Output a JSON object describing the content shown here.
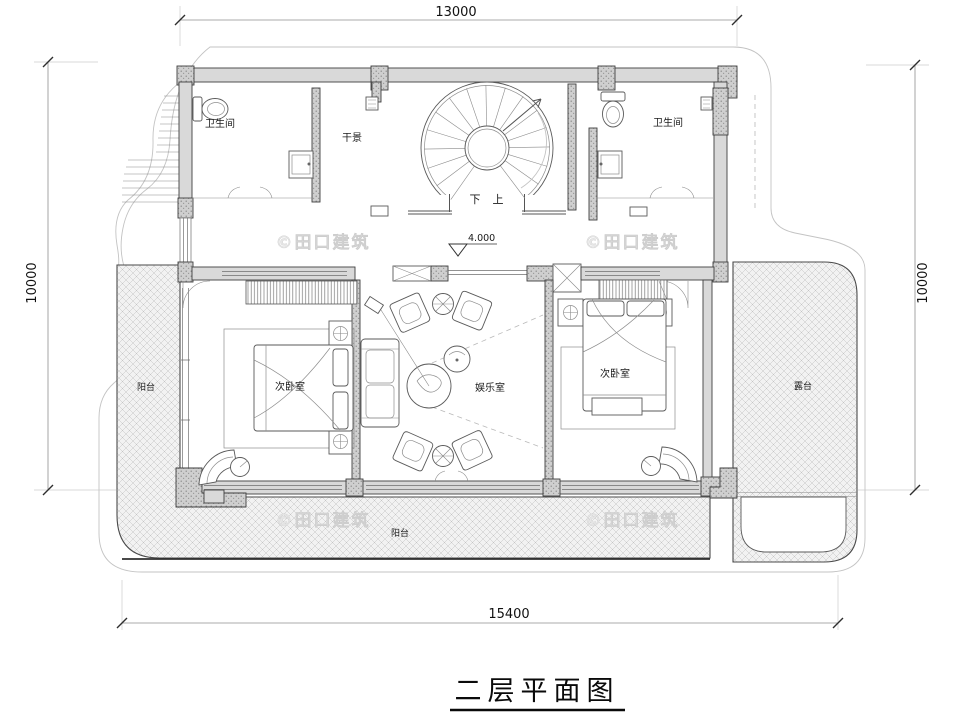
{
  "title": {
    "text": "二层平面图"
  },
  "dimensions": {
    "top": "13000",
    "bottom": "15400",
    "left": "10000",
    "right": "10000"
  },
  "elevation_label": "4.000",
  "stairs": {
    "down": "下",
    "up": "上"
  },
  "rooms": {
    "bathroom_left": "卫生间",
    "bathroom_right": "卫生间",
    "dry_landscape": "干景",
    "bedroom_left": "次卧室",
    "bedroom_right": "次卧室",
    "entertainment_room": "娱乐室",
    "balcony_left": "阳台",
    "balcony_bottom": "阳台",
    "terrace": "露台"
  },
  "watermark": "©田口建筑",
  "colors": {
    "wall_fill": "#d9d9d9",
    "wall_stroke": "#3f3f3f",
    "hatch_line": "#bdbdbd",
    "hatch_bg": "#f2f2f2",
    "watermark": "#e6e6e6",
    "dim_line": "#8f8f8f",
    "text": "#1b1b1b",
    "background": "#ffffff"
  }
}
